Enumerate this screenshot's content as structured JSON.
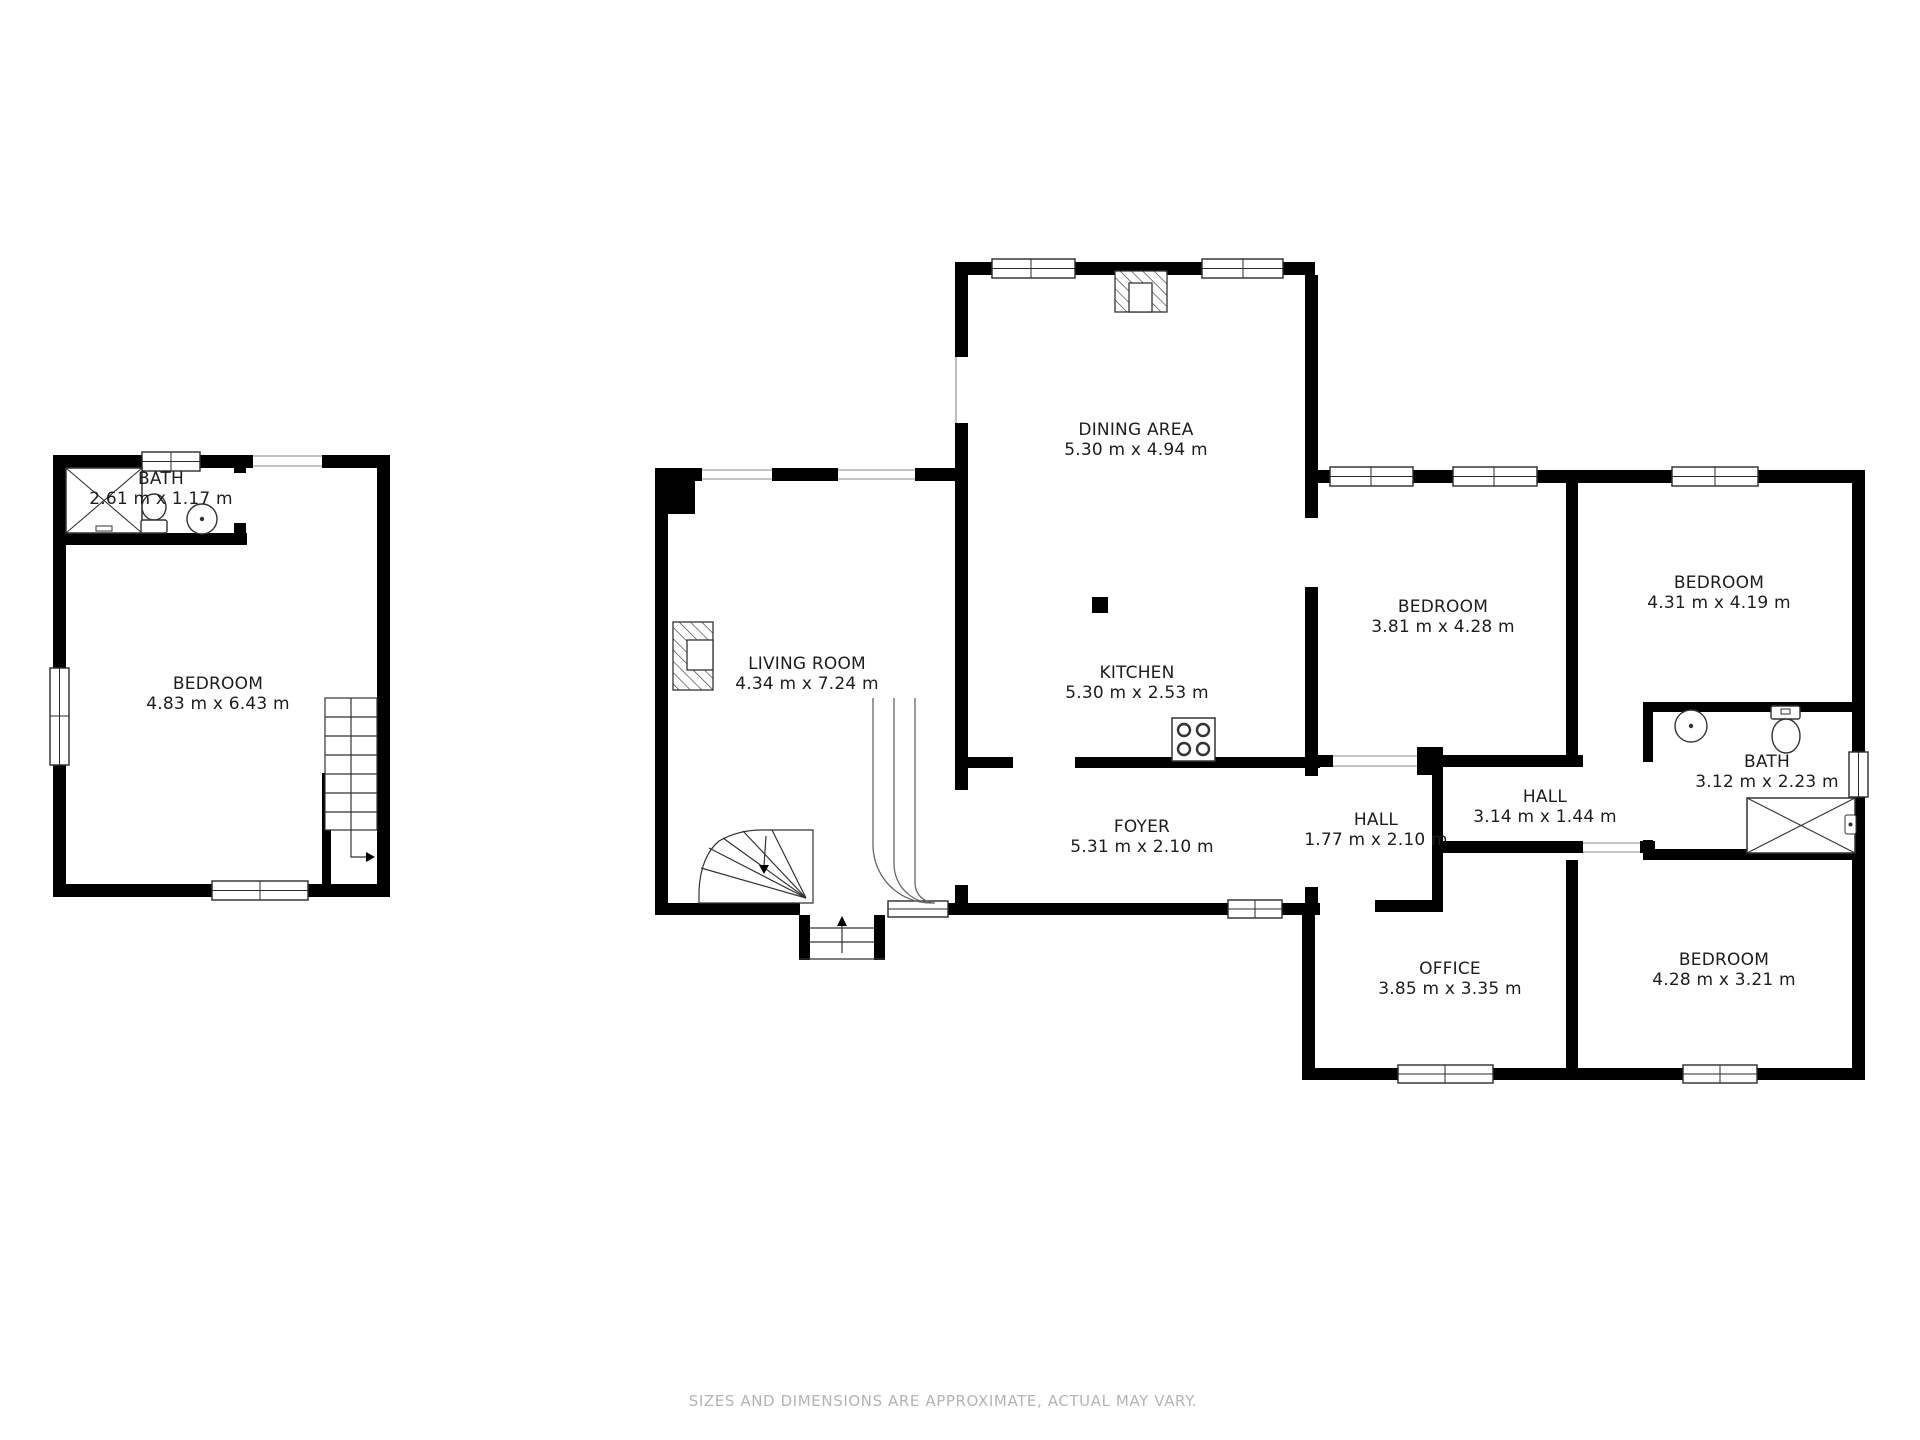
{
  "rooms": [
    {
      "name": "BATH",
      "dims": "2.61 m x 1.17 m"
    },
    {
      "name": "BEDROOM",
      "dims": "4.83 m x 6.43 m"
    },
    {
      "name": "DINING AREA",
      "dims": "5.30 m x 4.94 m"
    },
    {
      "name": "LIVING ROOM",
      "dims": "4.34 m x 7.24 m"
    },
    {
      "name": "KITCHEN",
      "dims": "5.30 m x 2.53 m"
    },
    {
      "name": "FOYER",
      "dims": "5.31 m x 2.10 m"
    },
    {
      "name": "HALL",
      "dims": "1.77 m x 2.10 m"
    },
    {
      "name": "HALL",
      "dims": "3.14 m x 1.44 m"
    },
    {
      "name": "BEDROOM",
      "dims": "3.81 m x 4.28 m"
    },
    {
      "name": "BEDROOM",
      "dims": "4.31 m x 4.19 m"
    },
    {
      "name": "BATH",
      "dims": "3.12 m x 2.23 m"
    },
    {
      "name": "OFFICE",
      "dims": "3.85 m x 3.35 m"
    },
    {
      "name": "BEDROOM",
      "dims": "4.28 m x 3.21 m"
    }
  ],
  "footer": {
    "disclaimer": "SIZES AND DIMENSIONS ARE APPROXIMATE, ACTUAL MAY VARY."
  },
  "colors": {
    "wall": "#000000",
    "text": "#1d1d1d",
    "muted": "#b4b4b4"
  }
}
